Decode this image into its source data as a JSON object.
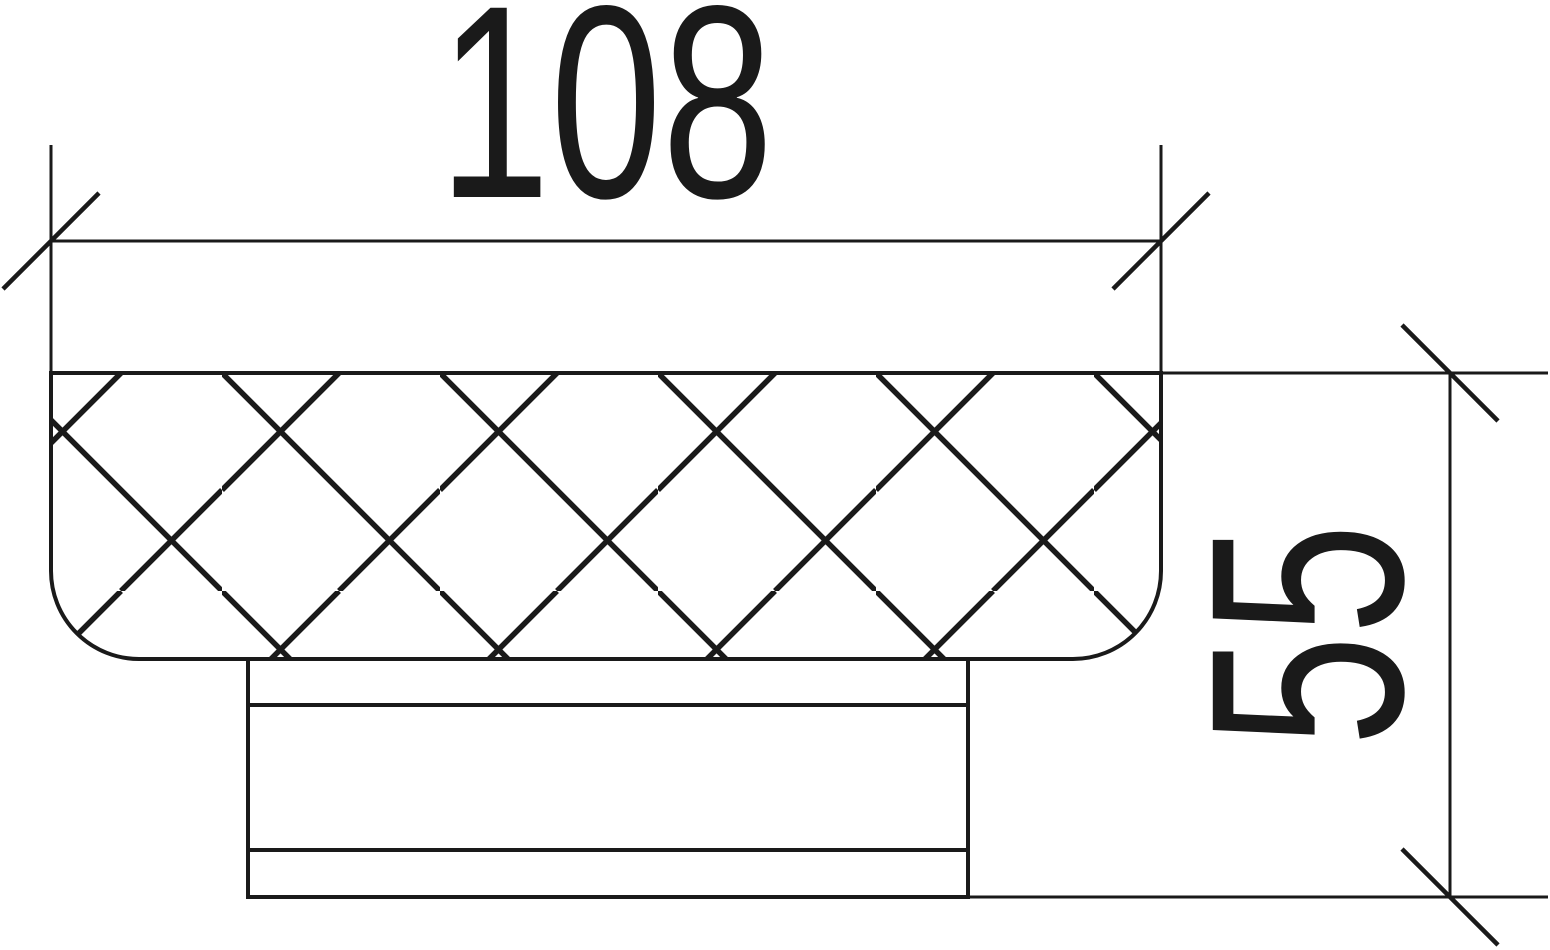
{
  "drawing": {
    "type": "technical-dimension-drawing",
    "subject": "knurled-knob-side-view-cross-section",
    "colors": {
      "ink": "#1a1a1a",
      "background": "#ffffff"
    },
    "dimensions": {
      "width": {
        "value": "108",
        "orientation": "horizontal",
        "tick_style": "oblique-slash"
      },
      "height": {
        "value": "55",
        "orientation": "vertical",
        "tick_style": "oblique-slash"
      }
    }
  }
}
